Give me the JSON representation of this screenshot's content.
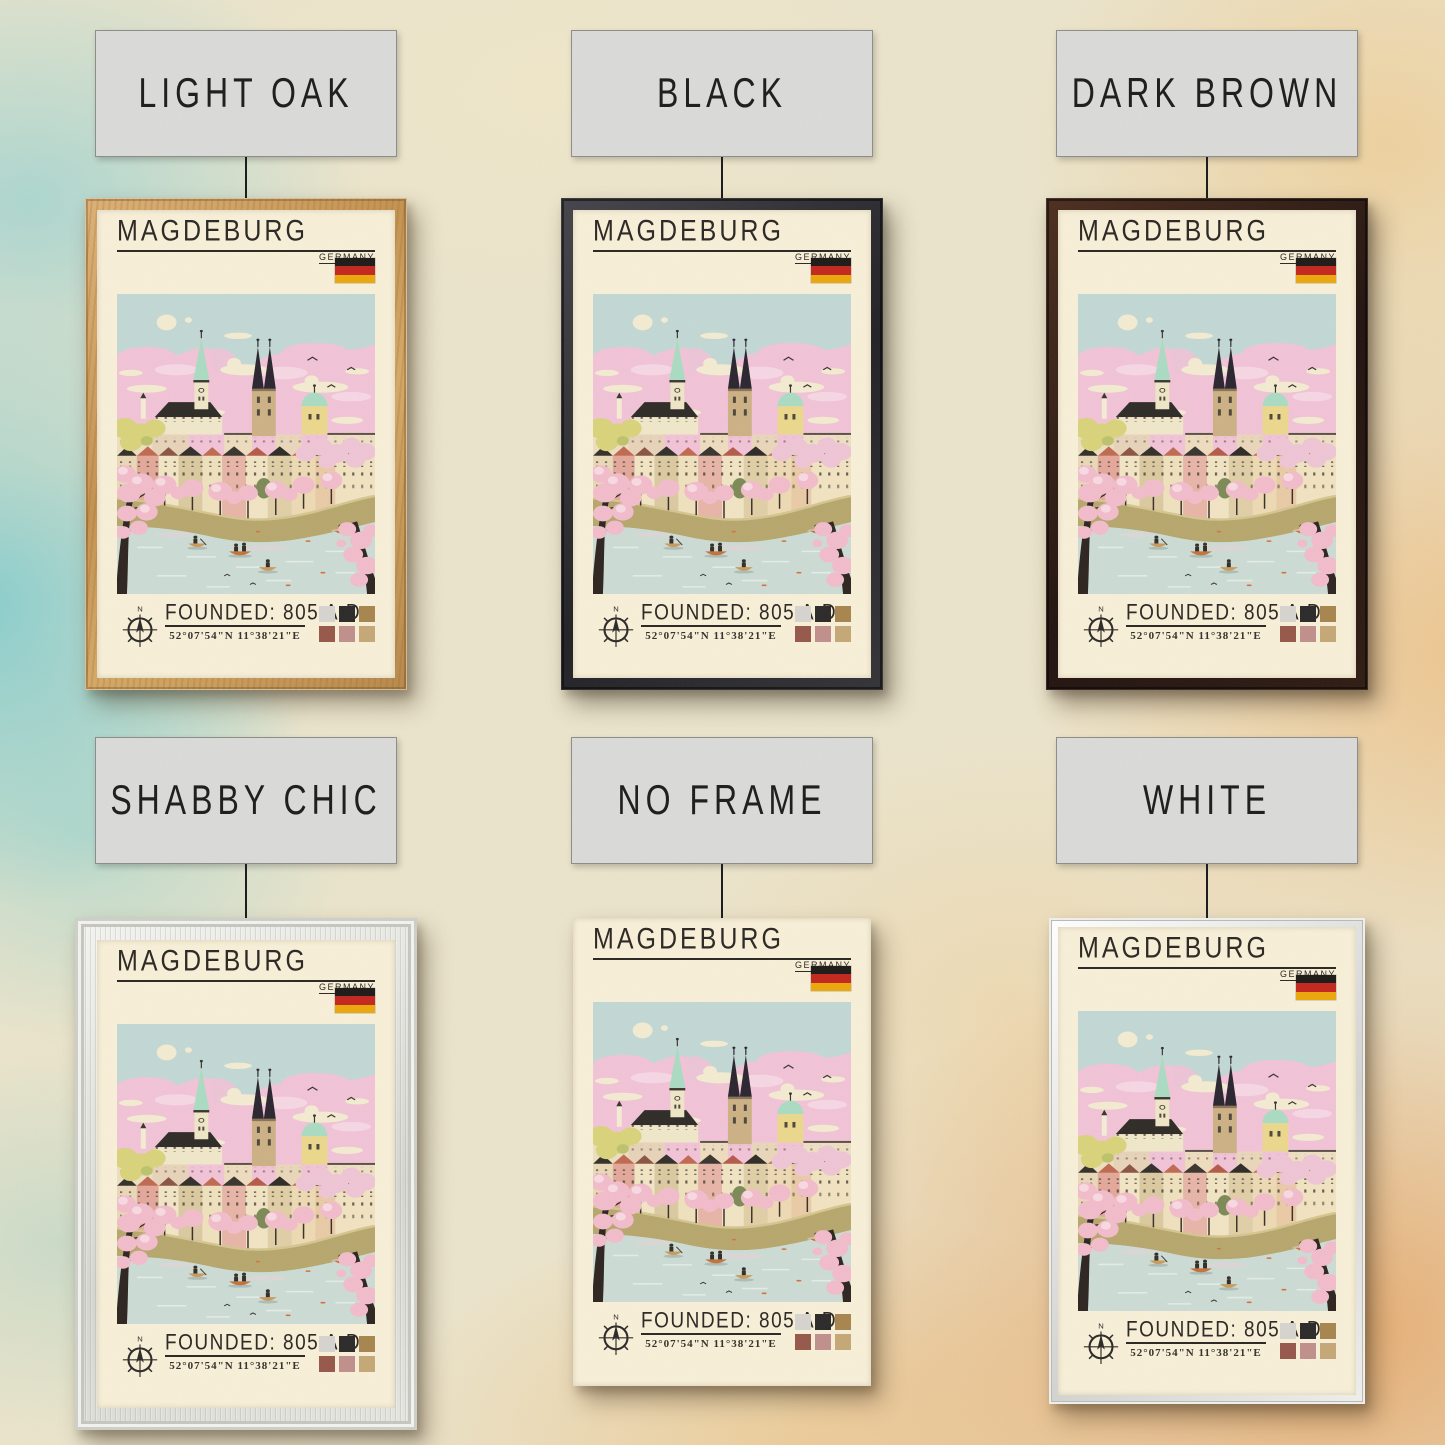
{
  "variants": [
    {
      "id": "light-oak",
      "label": "LIGHT OAK",
      "frame_color": "#c99c5e"
    },
    {
      "id": "black",
      "label": "BLACK",
      "frame_color": "#2b2b2d"
    },
    {
      "id": "dark-brown",
      "label": "DARK BROWN",
      "frame_color": "#2e1d15"
    },
    {
      "id": "shabby-chic",
      "label": "SHABBY CHIC",
      "frame_color": "#e3e3df"
    },
    {
      "id": "no-frame",
      "label": "NO FRAME",
      "frame_color": null
    },
    {
      "id": "white",
      "label": "WHITE",
      "frame_color": "#ececea"
    }
  ],
  "poster": {
    "title": "MAGDEBURG",
    "country": "GERMANY",
    "founded_text": "FOUNDED: 805 A.D..",
    "coordinates": "52°07'54\"N 11°38'21\"E",
    "compass": {
      "north_label": "N"
    },
    "flag_colors": [
      "#1d1a17",
      "#c3271e",
      "#eba70b"
    ],
    "palette_swatches": [
      "#d7d4cf",
      "#2c2a28",
      "#a8854e",
      "#96584a",
      "#c08f8b",
      "#c5a877"
    ],
    "paper_color": "#f8efd8",
    "art_colors": {
      "sky": "#c2d8d4",
      "clouds_pink": "#f1c3d6",
      "clouds_cream": "#f3ebd1",
      "river": "#cddbd5",
      "riverbank": "#b7a76d",
      "blossom": "#f2bccb",
      "spire_green": "#aadcc2",
      "tower_dark": "#2b2530",
      "tower_tan": "#ccb184",
      "tower_yellow": "#ebd88c",
      "roof_red": "#c06a52",
      "facade_cream": "#f0e7c9"
    }
  }
}
